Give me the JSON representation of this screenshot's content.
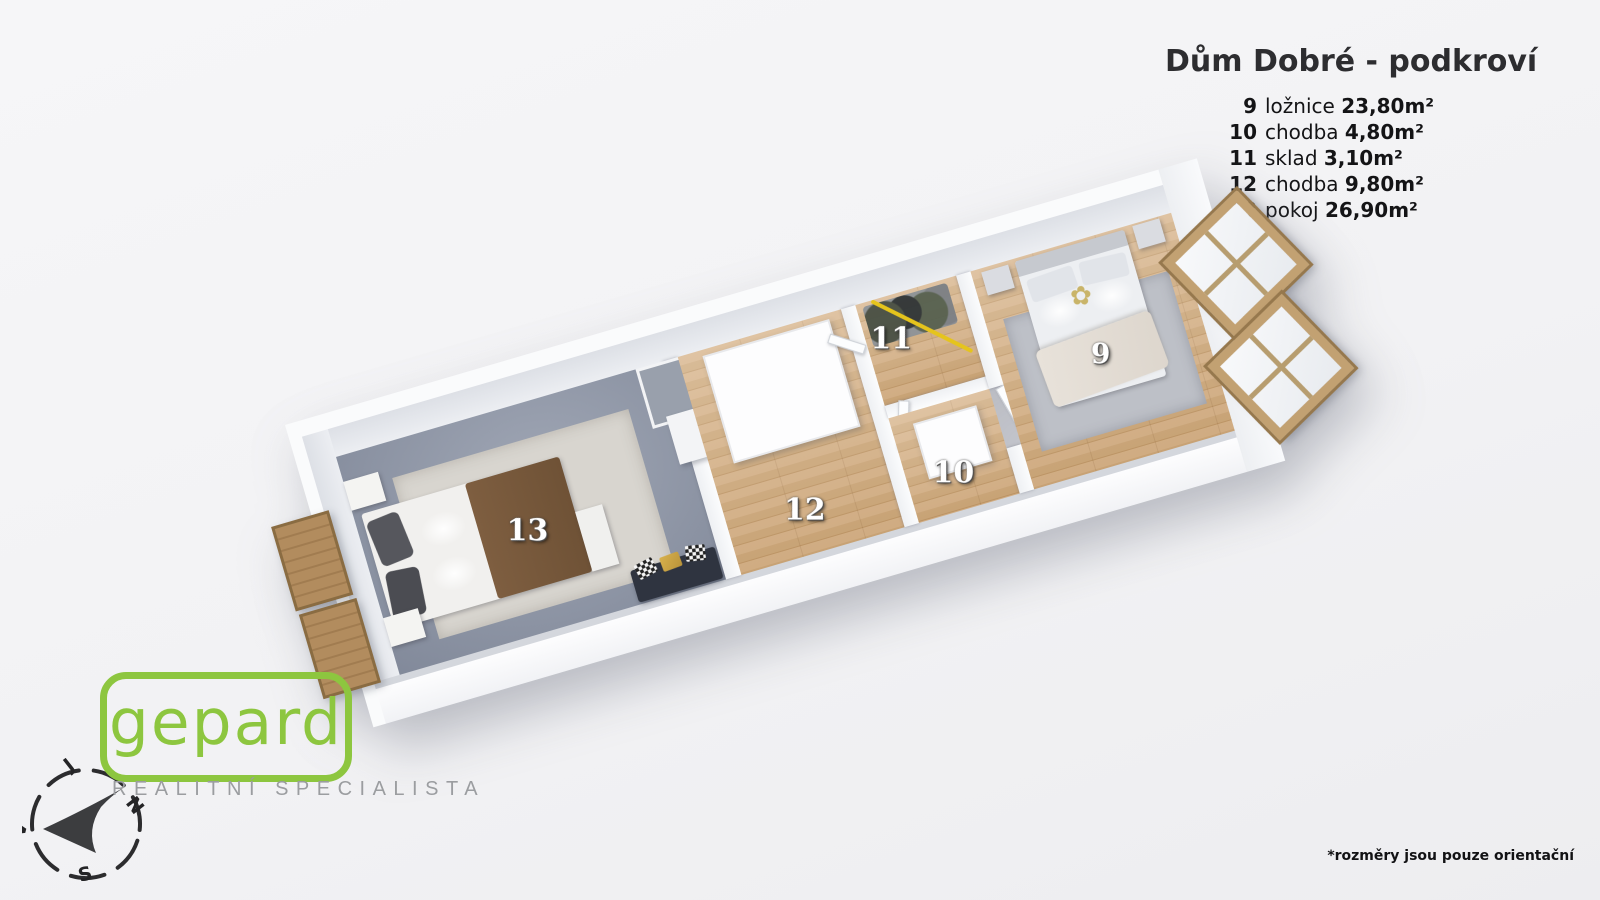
{
  "header": {
    "title": "Dům Dobré - podkroví"
  },
  "legend": [
    {
      "num": "9",
      "name": "ložnice",
      "area": "23,80m²"
    },
    {
      "num": "10",
      "name": "chodba",
      "area": "4,80m²"
    },
    {
      "num": "11",
      "name": "sklad",
      "area": "3,10m²"
    },
    {
      "num": "12",
      "name": "chodba",
      "area": "9,80m²"
    },
    {
      "num": "13",
      "name": "pokoj",
      "area": "26,90m²"
    }
  ],
  "plan": {
    "labels": {
      "r9": "9",
      "r10": "10",
      "r11": "11",
      "r12": "12",
      "r13": "13"
    },
    "flower_icon": "✿"
  },
  "branding": {
    "logo": "gepard",
    "tagline": "REALITNÍ SPECIALISTA"
  },
  "compass": {
    "n": "N",
    "s": "S",
    "v": "V",
    "j": "J"
  },
  "footnote": "*rozměry jsou pouze orientační",
  "colors": {
    "logo_green": "#8dc63f",
    "carpet_gray": "#8e96a7",
    "wood_floor": "#cda87a",
    "wall_white": "#f7f8fa",
    "rail_yellow": "#e5c41c",
    "title_text": "#2d2d30"
  }
}
